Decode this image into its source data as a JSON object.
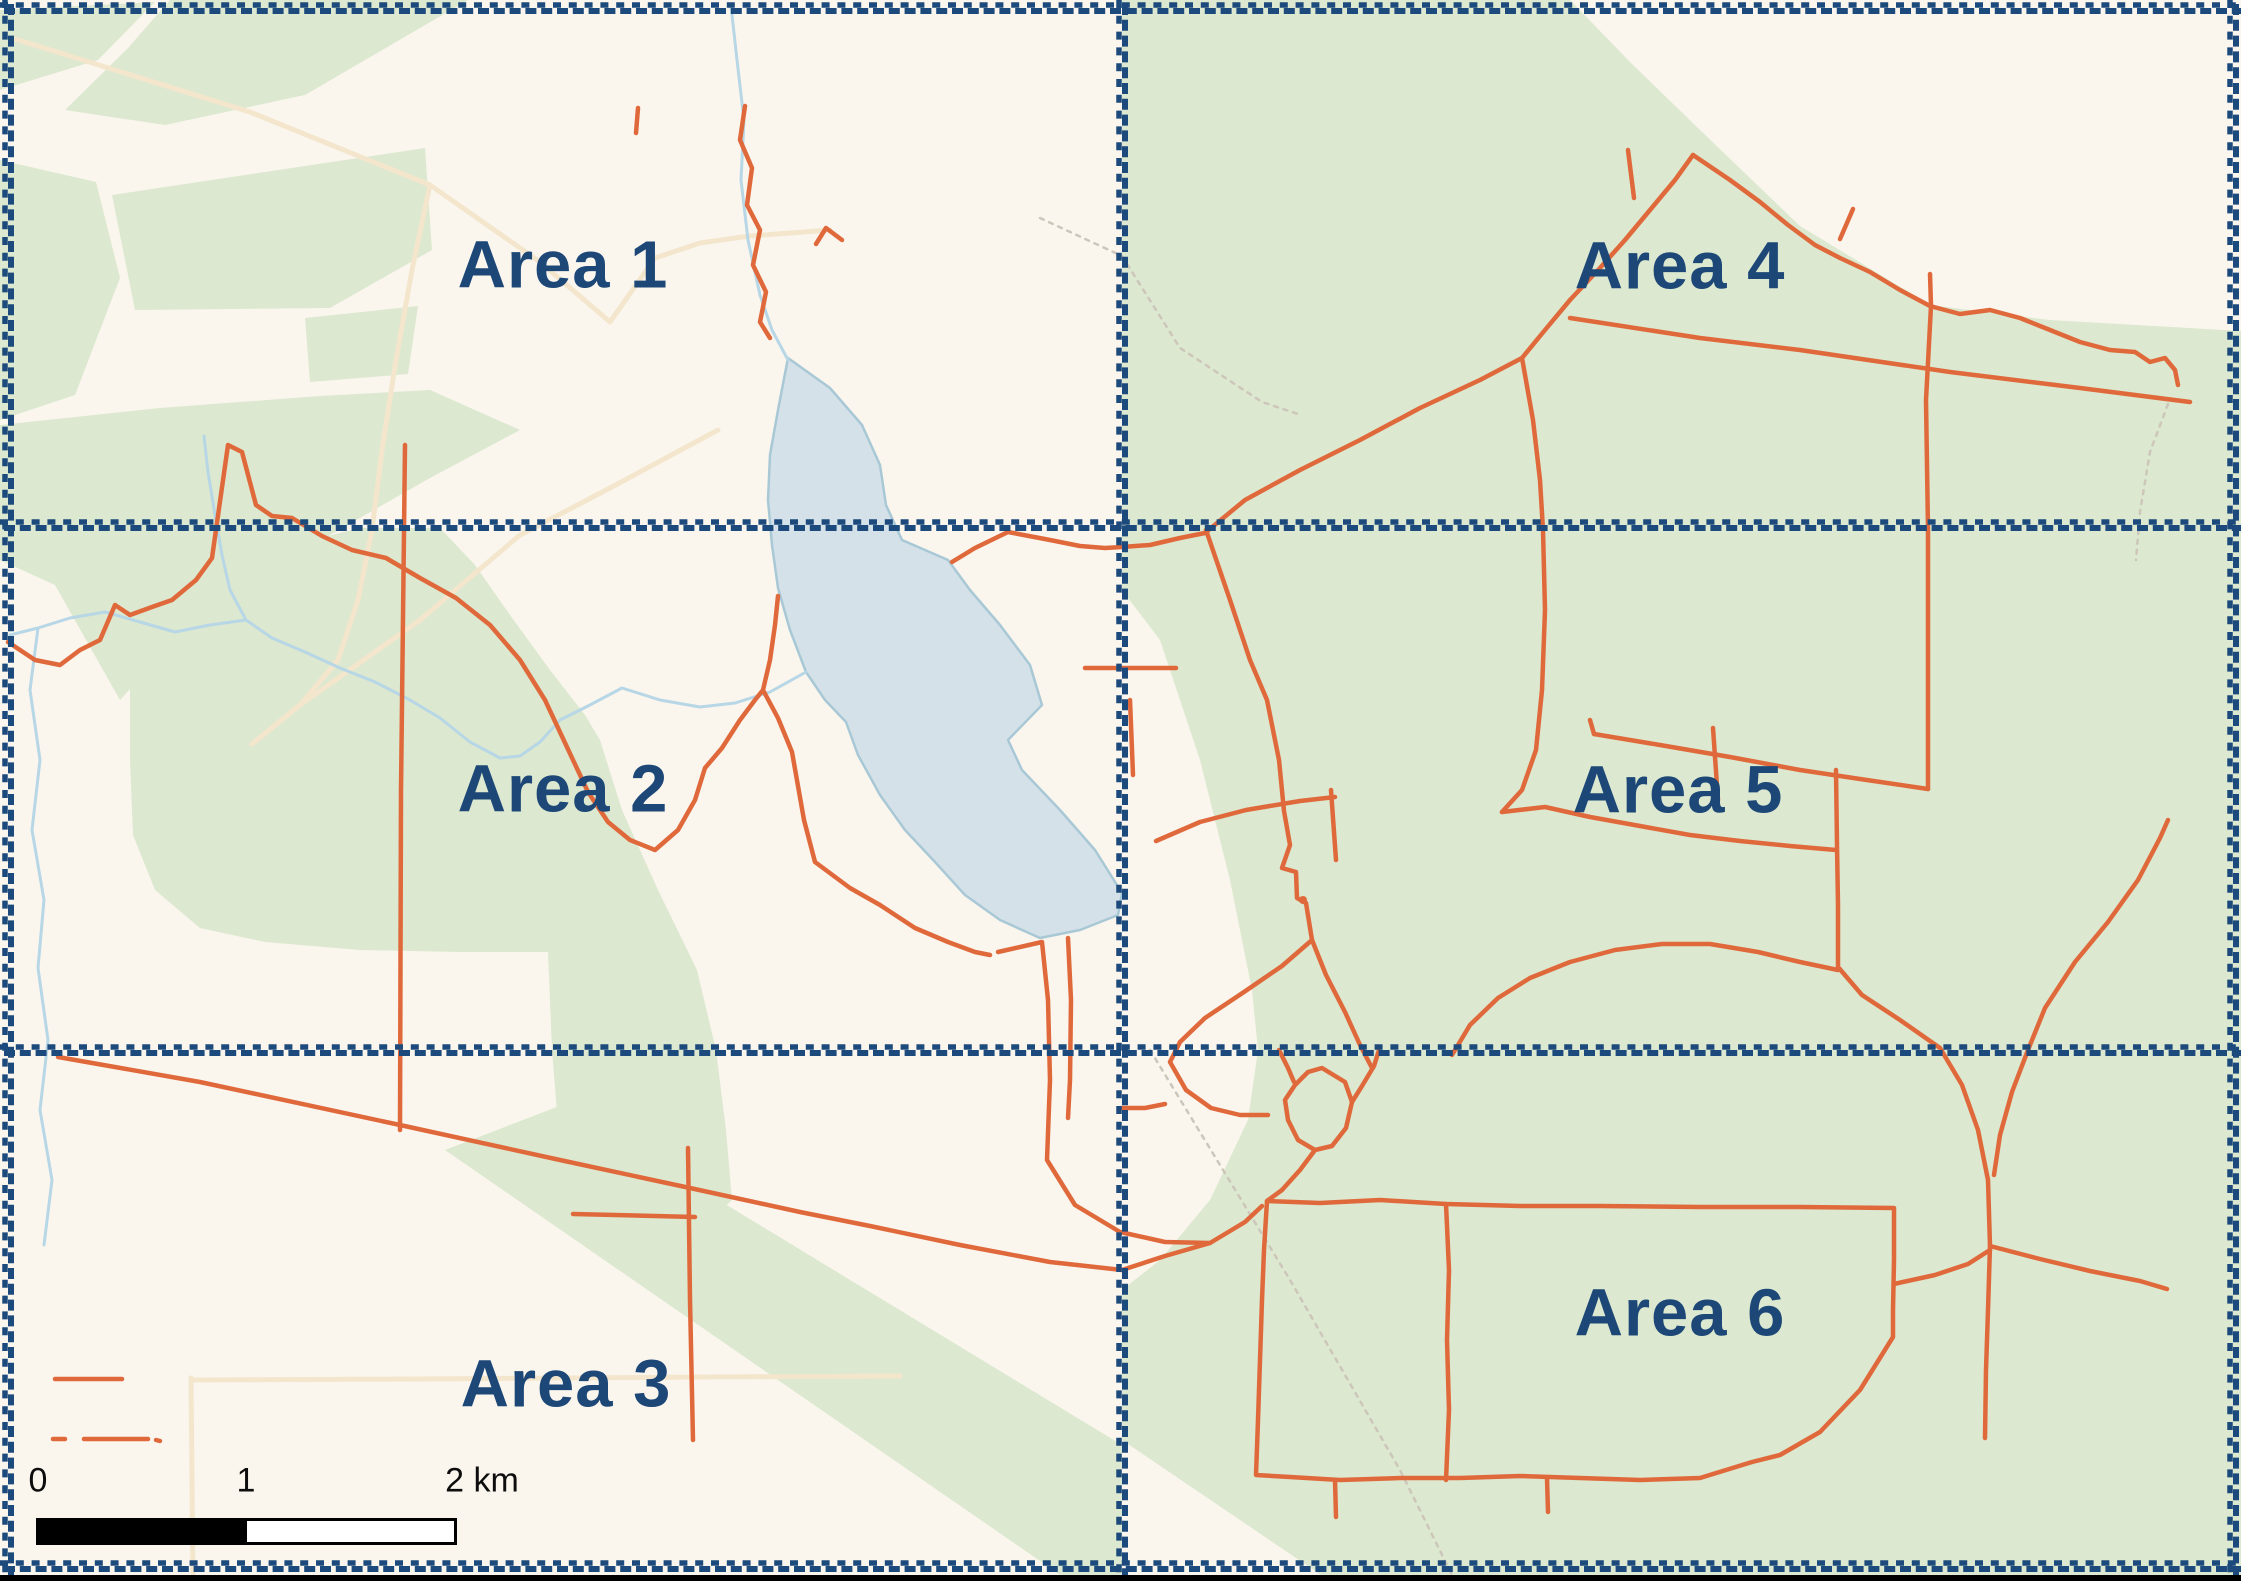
{
  "map": {
    "title": "Survey area map divided into six labelled zones",
    "areas": [
      {
        "label": "Area 1"
      },
      {
        "label": "Area 2"
      },
      {
        "label": "Area 3"
      },
      {
        "label": "Area 4"
      },
      {
        "label": "Area 5"
      },
      {
        "label": "Area 6"
      }
    ],
    "scale_bar": {
      "tick_0": "0",
      "tick_1": "1",
      "tick_2": "2 km"
    },
    "colors": {
      "background_cream": "#faf6ee",
      "forest_green": "#dce8cf",
      "water_fill": "#d4e1e8",
      "water_line": "#a9c8d6",
      "road_orange": "#e0693c",
      "boundary_navy": "#1d4a7c",
      "label_navy": "#1c4777",
      "scalebar_black": "#000000"
    }
  }
}
